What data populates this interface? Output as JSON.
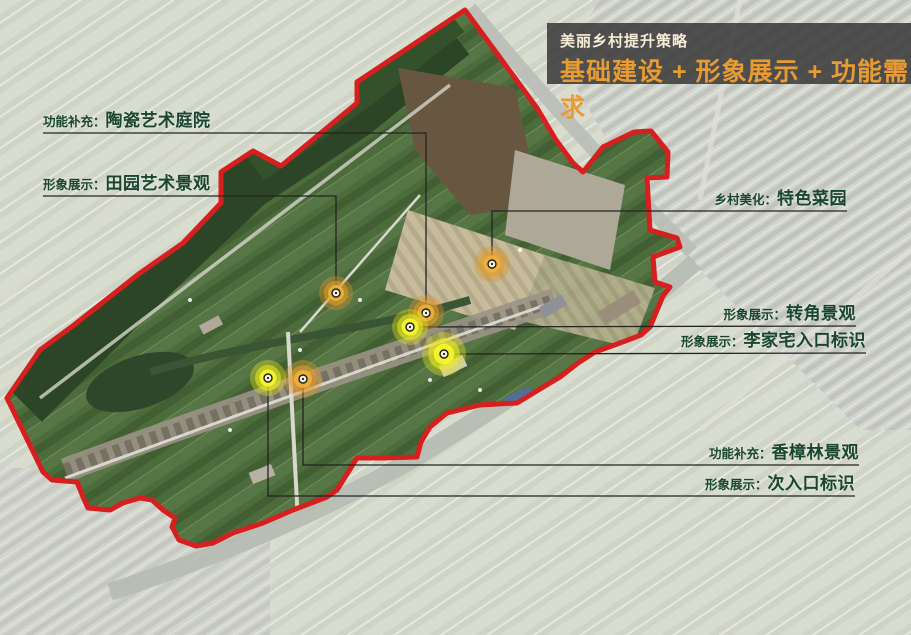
{
  "title_block": {
    "subtitle": "美丽乡村提升策略",
    "title": "基础建设 + 形象展示 + 功能需求",
    "bg_color": "#343434",
    "subtitle_color": "#f6ecd8",
    "title_color": "#e89b33"
  },
  "annotations": [
    {
      "id": "taoci-tingyuan",
      "prefix": "功能补充：",
      "name": "陶瓷艺术庭院",
      "align": "left",
      "text_x": 43,
      "text_y": 111,
      "leader": [
        [
          43,
          133
        ],
        [
          426,
          133
        ],
        [
          426,
          308
        ]
      ],
      "marker": {
        "color": "orange",
        "x": 426,
        "y": 313,
        "r": 18
      }
    },
    {
      "id": "tianyuan-jingguan",
      "prefix": "形象展示：",
      "name": "田园艺术景观",
      "align": "left",
      "text_x": 43,
      "text_y": 174,
      "leader": [
        [
          43,
          196
        ],
        [
          336,
          196
        ],
        [
          336,
          288
        ]
      ],
      "marker": {
        "color": "orange",
        "x": 336,
        "y": 293,
        "r": 17
      }
    },
    {
      "id": "tese-caiyuan",
      "prefix": "乡村美化：",
      "name": "特色菜园",
      "align": "right",
      "text_x": 847,
      "text_y": 189,
      "leader": [
        [
          847,
          211
        ],
        [
          492,
          211
        ],
        [
          492,
          259
        ]
      ],
      "marker": {
        "color": "orange",
        "x": 492,
        "y": 264,
        "r": 18
      }
    },
    {
      "id": "zhuanjiao-jingguan",
      "prefix": "形象展示：",
      "name": "转角景观",
      "align": "right",
      "text_x": 856,
      "text_y": 304,
      "leader": [
        [
          856,
          326
        ],
        [
          414,
          327
        ]
      ],
      "marker": {
        "color": "yellow",
        "x": 410,
        "y": 327,
        "r": 18
      }
    },
    {
      "id": "lijiazhai-rukou",
      "prefix": "形象展示：",
      "name": "李家宅入口标识",
      "align": "right",
      "text_x": 866,
      "text_y": 331,
      "leader": [
        [
          866,
          353
        ],
        [
          448,
          354
        ]
      ],
      "marker": {
        "color": "yellow",
        "x": 444,
        "y": 354,
        "r": 22
      }
    },
    {
      "id": "xiangzhanglin-jingguan",
      "prefix": "功能补充：",
      "name": "香樟林景观",
      "align": "right",
      "text_x": 859,
      "text_y": 443,
      "leader": [
        [
          859,
          465
        ],
        [
          303,
          465
        ],
        [
          303,
          384
        ]
      ],
      "marker": {
        "color": "orange",
        "x": 303,
        "y": 379,
        "r": 19
      }
    },
    {
      "id": "cirukou-biaoshi",
      "prefix": "形象展示：",
      "name": "次入口标识",
      "align": "right",
      "text_x": 855,
      "text_y": 474,
      "leader": [
        [
          855,
          496
        ],
        [
          268,
          496
        ],
        [
          268,
          383
        ]
      ],
      "marker": {
        "color": "yellow",
        "x": 268,
        "y": 378,
        "r": 18
      }
    }
  ],
  "marker_palettes": {
    "orange": {
      "outer": "rgba(222,148,38,0.38)",
      "mid": "rgba(228,158,44,0.55)",
      "inner": "rgba(240,178,62,0.88)"
    },
    "yellow": {
      "outer": "rgba(226,226,28,0.38)",
      "mid": "rgba(234,234,28,0.58)",
      "inner": "rgba(246,246,44,0.92)"
    }
  },
  "boundary": {
    "stroke_color": "#d71f1f",
    "points": [
      [
        465,
        10
      ],
      [
        537,
        108
      ],
      [
        556,
        140
      ],
      [
        573,
        163
      ],
      [
        583,
        172
      ],
      [
        603,
        147
      ],
      [
        634,
        132
      ],
      [
        651,
        131
      ],
      [
        668,
        152
      ],
      [
        667,
        177
      ],
      [
        647,
        178
      ],
      [
        650,
        230
      ],
      [
        677,
        238
      ],
      [
        680,
        247
      ],
      [
        653,
        257
      ],
      [
        655,
        282
      ],
      [
        670,
        287
      ],
      [
        663,
        296
      ],
      [
        650,
        327
      ],
      [
        641,
        335
      ],
      [
        620,
        343
      ],
      [
        595,
        352
      ],
      [
        578,
        363
      ],
      [
        560,
        377
      ],
      [
        545,
        386
      ],
      [
        517,
        403
      ],
      [
        480,
        405
      ],
      [
        447,
        413
      ],
      [
        430,
        427
      ],
      [
        421,
        442
      ],
      [
        417,
        457
      ],
      [
        383,
        458
      ],
      [
        357,
        458
      ],
      [
        337,
        490
      ],
      [
        327,
        497
      ],
      [
        293,
        510
      ],
      [
        263,
        523
      ],
      [
        233,
        533
      ],
      [
        213,
        543
      ],
      [
        196,
        546
      ],
      [
        179,
        540
      ],
      [
        172,
        527
      ],
      [
        175,
        518
      ],
      [
        163,
        510
      ],
      [
        152,
        500
      ],
      [
        140,
        498
      ],
      [
        123,
        503
      ],
      [
        110,
        510
      ],
      [
        88,
        508
      ],
      [
        83,
        497
      ],
      [
        77,
        482
      ],
      [
        52,
        480
      ],
      [
        43,
        472
      ],
      [
        7,
        398
      ],
      [
        40,
        350
      ],
      [
        74,
        325
      ],
      [
        140,
        273
      ],
      [
        183,
        243
      ],
      [
        221,
        203
      ],
      [
        221,
        172
      ],
      [
        253,
        151
      ],
      [
        281,
        166
      ],
      [
        357,
        103
      ],
      [
        357,
        82
      ]
    ]
  }
}
